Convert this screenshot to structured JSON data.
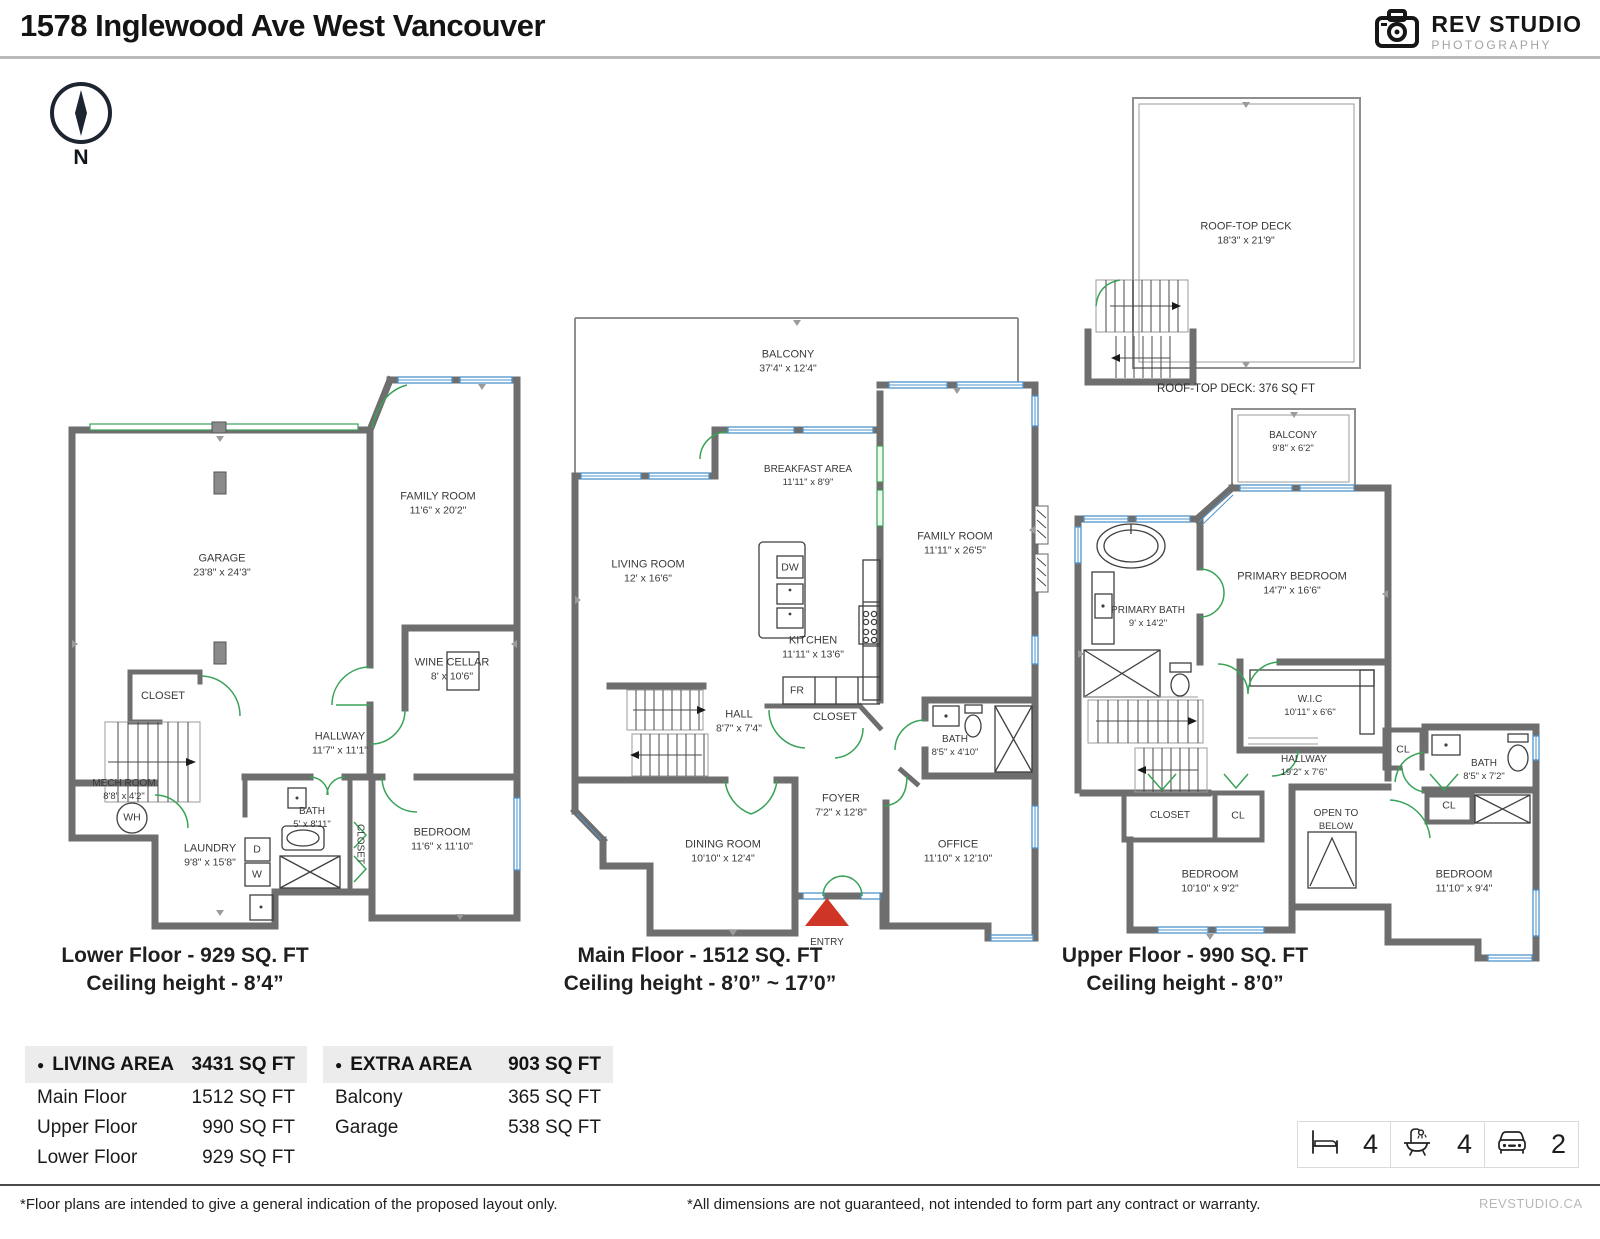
{
  "header": {
    "title": "1578 Inglewood Ave West Vancouver",
    "brand": "REV STUDIO",
    "brand_sub": "PHOTOGRAPHY"
  },
  "compass_label": "N",
  "floors": [
    {
      "id": "lower",
      "caption": "Lower Floor - 929 SQ. FT",
      "ceiling": "Ceiling height - 8’4”",
      "rooms": [
        {
          "label": "GARAGE",
          "dims": "23'8\" x 24'3\"",
          "x": 162,
          "y": 196
        },
        {
          "label": "FAMILY ROOM",
          "dims": "11'6\" x 20'2\"",
          "x": 378,
          "y": 134
        },
        {
          "label": "WINE CELLAR",
          "dims": "8' x 10'6\"",
          "x": 392,
          "y": 300
        },
        {
          "label": "CLOSET",
          "x": 103,
          "y": 327
        },
        {
          "label": "HALLWAY",
          "dims": "11'7\" x 11'1\"",
          "x": 280,
          "y": 374
        },
        {
          "label": "MECH ROOM",
          "dims": "8'8\" x 4'2\"",
          "x": 64,
          "y": 420,
          "cls": "small"
        },
        {
          "label": "WH",
          "x": 72,
          "y": 448,
          "cls": "tiny"
        },
        {
          "label": "LAUNDRY",
          "dims": "9'8\" x 15'8\"",
          "x": 150,
          "y": 486
        },
        {
          "label": "BATH",
          "dims": "5' x 8'11\"",
          "x": 252,
          "y": 448,
          "cls": "small"
        },
        {
          "label": "CLOSET",
          "x": 299,
          "y": 474,
          "cls": "rot small"
        },
        {
          "label": "D",
          "x": 197,
          "y": 480,
          "cls": "tiny"
        },
        {
          "label": "W",
          "x": 197,
          "y": 505,
          "cls": "tiny"
        },
        {
          "label": "BEDROOM",
          "dims": "11'6\" x 11'10\"",
          "x": 382,
          "y": 470
        }
      ]
    },
    {
      "id": "main",
      "caption": "Main Floor - 1512 SQ. FT",
      "ceiling": "Ceiling height - 8’0” ~ 17’0”",
      "rooms": [
        {
          "label": "BALCONY",
          "dims": "37'4\" x 12'4\"",
          "x": 225,
          "y": 56
        },
        {
          "label": "BREAKFAST AREA",
          "dims": "11'11\" x 8'9\"",
          "x": 245,
          "y": 170,
          "cls": "small"
        },
        {
          "label": "LIVING ROOM",
          "dims": "12' x 16'6\"",
          "x": 85,
          "y": 266
        },
        {
          "label": "FAMILY ROOM",
          "dims": "11'11\" x 26'5\"",
          "x": 392,
          "y": 238
        },
        {
          "label": "KITCHEN",
          "dims": "11'11\" x 13'6\"",
          "x": 250,
          "y": 342
        },
        {
          "label": "DW",
          "x": 227,
          "y": 262,
          "cls": "tiny"
        },
        {
          "label": "FR",
          "x": 234,
          "y": 385,
          "cls": "tiny"
        },
        {
          "label": "HALL",
          "dims": "8'7\" x 7'4\"",
          "x": 176,
          "y": 416
        },
        {
          "label": "CLOSET",
          "x": 272,
          "y": 412
        },
        {
          "label": "BATH",
          "dims": "8'5\" x 4'10\"",
          "x": 392,
          "y": 440,
          "cls": "small"
        },
        {
          "label": "FOYER",
          "dims": "7'2\" x 12'8\"",
          "x": 278,
          "y": 500
        },
        {
          "label": "DINING ROOM",
          "dims": "10'10\" x 12'4\"",
          "x": 160,
          "y": 546
        },
        {
          "label": "OFFICE",
          "dims": "11'10\" x 12'10\"",
          "x": 395,
          "y": 546
        },
        {
          "label": "ENTRY",
          "x": 264,
          "y": 637,
          "cls": "small"
        }
      ]
    },
    {
      "id": "upper",
      "caption": "Upper Floor - 990 SQ. FT",
      "ceiling": "Ceiling height - 8’0”",
      "rooftop_note": "ROOF-TOP DECK: 376 SQ FT",
      "rooms": [
        {
          "label": "ROOF-TOP DECK",
          "dims": "18'3\" x 21'9\"",
          "x": 188,
          "y": 144
        },
        {
          "label": "BALCONY",
          "dims": "9'8\" x 6'2\"",
          "x": 235,
          "y": 352,
          "cls": "small"
        },
        {
          "label": "PRIMARY BATH",
          "dims": "9' x 14'2\"",
          "x": 90,
          "y": 527,
          "cls": "small"
        },
        {
          "label": "PRIMARY BEDROOM",
          "dims": "14'7\" x 16'6\"",
          "x": 234,
          "y": 494
        },
        {
          "label": "W.I.C",
          "dims": "10'11\" x 6'6\"",
          "x": 252,
          "y": 616,
          "cls": "small"
        },
        {
          "label": "HALLWAY",
          "dims": "19'2\" x 7'6\"",
          "x": 246,
          "y": 676,
          "cls": "small"
        },
        {
          "label": "CL",
          "x": 345,
          "y": 660,
          "cls": "tiny"
        },
        {
          "label": "BATH",
          "dims": "8'5\" x 7'2\"",
          "x": 426,
          "y": 680,
          "cls": "small"
        },
        {
          "label": "CLOSET",
          "x": 112,
          "y": 726,
          "cls": "small"
        },
        {
          "label": "CL",
          "x": 180,
          "y": 726,
          "cls": "tiny"
        },
        {
          "label": "CL",
          "x": 391,
          "y": 716,
          "cls": "tiny"
        },
        {
          "label": "OPEN TO",
          "dims": "BELOW",
          "x": 278,
          "y": 730,
          "cls": "small"
        },
        {
          "label": "BEDROOM",
          "dims": "10'10\" x 9'2\"",
          "x": 152,
          "y": 792
        },
        {
          "label": "BEDROOM",
          "dims": "11'10\" x 9'4\"",
          "x": 406,
          "y": 792
        }
      ]
    }
  ],
  "tables": {
    "living": {
      "bullet": "●",
      "title": "LIVING AREA",
      "total": "3431 SQ FT",
      "rows": [
        {
          "name": "Main Floor",
          "value": "1512 SQ FT"
        },
        {
          "name": "Upper Floor",
          "value": "990 SQ FT"
        },
        {
          "name": "Lower Floor",
          "value": "929 SQ FT"
        }
      ]
    },
    "extra": {
      "bullet": "●",
      "title": "EXTRA AREA",
      "total": "903 SQ FT",
      "rows": [
        {
          "name": "Balcony",
          "value": "365 SQ FT"
        },
        {
          "name": "Garage",
          "value": "538 SQ FT"
        }
      ]
    }
  },
  "stats": [
    {
      "icon": "bed-icon",
      "value": "4"
    },
    {
      "icon": "bath-icon",
      "value": "4"
    },
    {
      "icon": "car-icon",
      "value": "2"
    }
  ],
  "footer": {
    "left": "*Floor plans are intended to give a general indication of the proposed layout only.",
    "center": "*All dimensions are not guaranteed, not intended to form part any contract or warranty.",
    "right": "REVSTUDIO.CA"
  }
}
